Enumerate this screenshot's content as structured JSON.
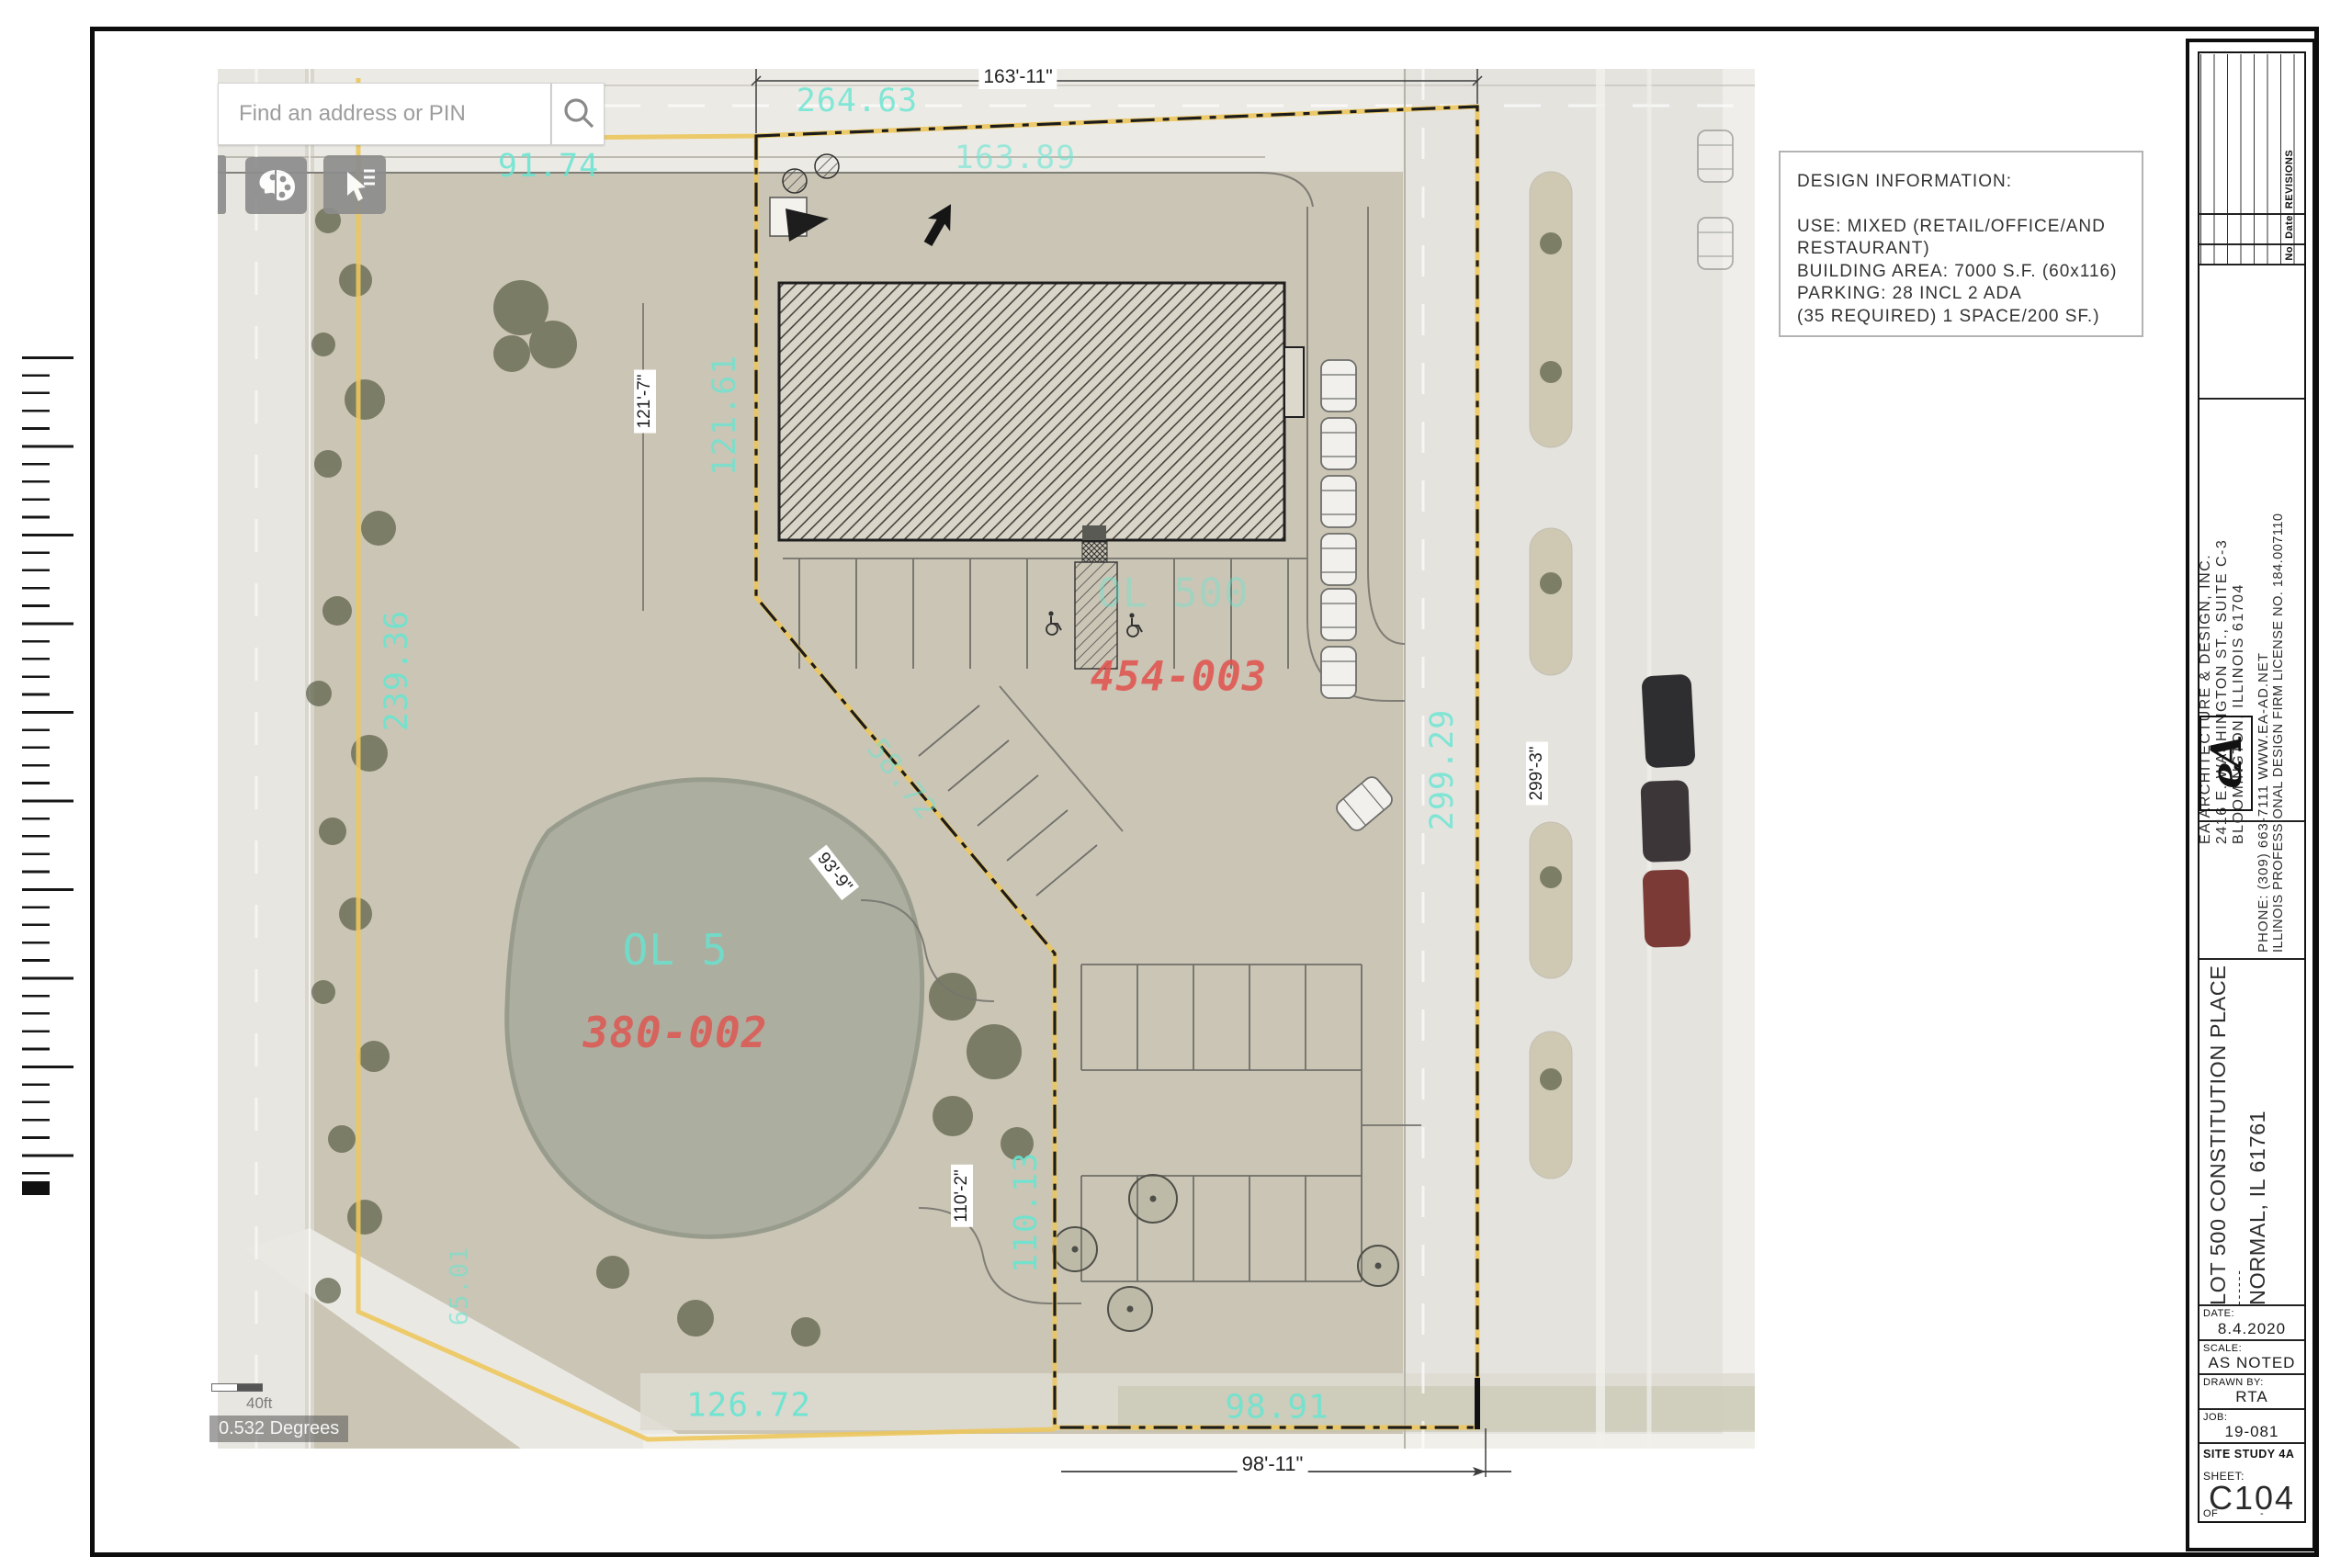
{
  "map": {
    "search": {
      "placeholder": "Find an address or PIN"
    },
    "scalebar": {
      "distance": "40ft",
      "degrees": "0.532 Degrees"
    },
    "labels": {
      "dim_top": "163'-11\"",
      "meas_264": "264.63",
      "meas_163": "163.89",
      "meas_91": "91.74",
      "meas_121": "121.61",
      "dim_121": "121'-7\"",
      "meas_239": "239.36",
      "meas_58": "58.72",
      "dim_93": "93'-9\"",
      "meas_299": "299.29",
      "dim_299": "299'-3\"",
      "parcel_ol500": "OL 500",
      "pin_454": "454-003",
      "parcel_ol5": "OL 5",
      "pin_380": "380-002",
      "meas_110": "110.13",
      "dim_110": "110'-2\"",
      "meas_65": "65.01",
      "meas_126": "126.72",
      "meas_98": "98.91",
      "dim_98": "98'-11\""
    }
  },
  "design_info": {
    "title": "DESIGN INFORMATION:",
    "lines": [
      "USE: MIXED (RETAIL/OFFICE/AND",
      "RESTAURANT)",
      "BUILDING AREA: 7000 S.F. (60x116)",
      "PARKING:  28 INCL 2 ADA",
      "(35 REQUIRED) 1 SPACE/200 SF.)"
    ]
  },
  "titleblock": {
    "revisions": {
      "col_rev": "REVISIONS",
      "col_date": "Date",
      "col_no": "No."
    },
    "firm": {
      "logo": "eA",
      "name": "EA ARCHITECTURE & DESIGN, INC.",
      "address1": "2416 E. WASHINGTON ST., SUITE C-3",
      "address2": "BLOOMINGTON, ILLINOIS 61704",
      "phone": "PHONE: (309) 663-7111    WWW.EA-AD.NET",
      "license": "ILLINOIS PROFESSIONAL DESIGN FIRM LICENSE NO.  184.007110"
    },
    "project": {
      "line1": "LOT 500 CONSTITUTION PLACE",
      "line2": "------",
      "line3": "NORMAL, IL 61761"
    },
    "fields": [
      {
        "label": "DATE:",
        "value": "8.4.2020"
      },
      {
        "label": "SCALE:",
        "value": "AS NOTED"
      },
      {
        "label": "DRAWN BY:",
        "value": "RTA"
      },
      {
        "label": "JOB:",
        "value": "19-081"
      }
    ],
    "study": "SITE STUDY 4A",
    "sheet_label": "SHEET:",
    "sheet": "C104",
    "of_label": "OF",
    "of_value": "-"
  },
  "colors": {
    "boundary_yellow": "#edc75d",
    "gis_cyan": "#66e6d2",
    "gis_red": "#e2514d"
  }
}
